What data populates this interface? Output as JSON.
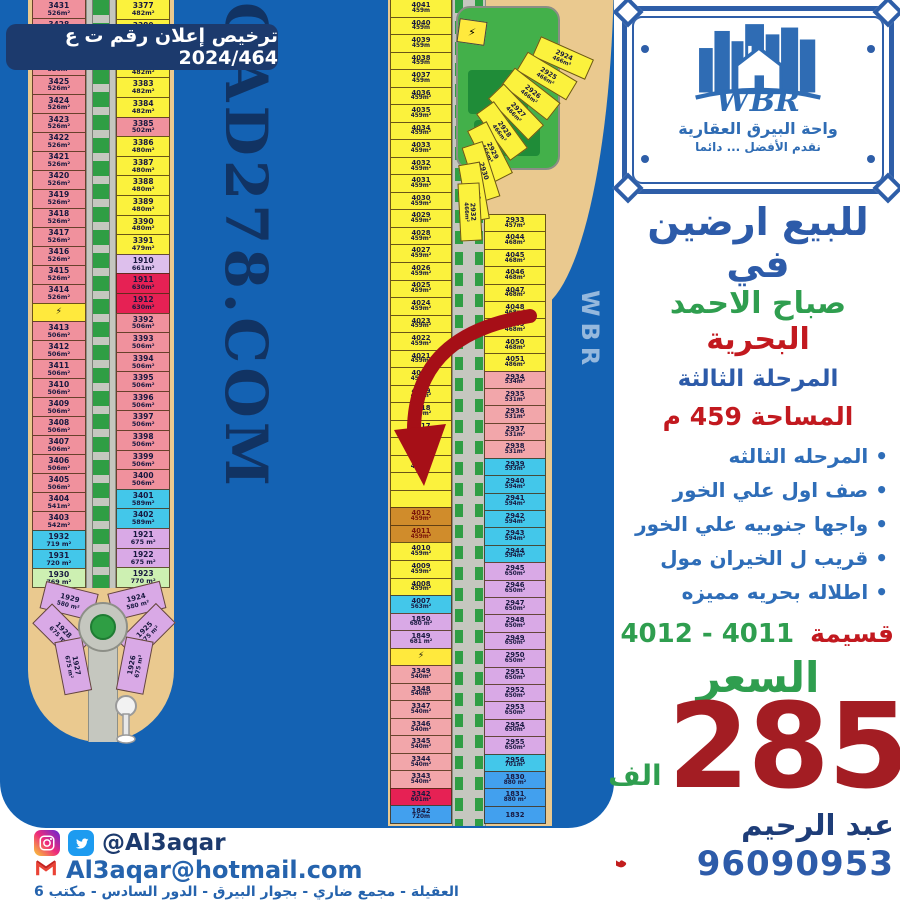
{
  "license": {
    "text": "ترخيص إعلان رقم ت ع 2024/464"
  },
  "logo": {
    "brand": "WBR",
    "line1": "واحة البيرق العقارية",
    "line2": "نقدم الأفضل ... دائما"
  },
  "panel": {
    "headline": "للبيع ارضين في",
    "location_green": "صباح الاحمد",
    "location_red": "البحرية",
    "phase": "المرحلة الثالثة",
    "area_line": "المساحة 459 م",
    "features": [
      {
        "label": "المرحله الثالثه"
      },
      {
        "label": "صف اول علي الخور"
      },
      {
        "label": "واجها جنوبيه علي الخور"
      },
      {
        "label": "قريب ل الخيران مول"
      },
      {
        "label": "اطلاله بحريه مميزه"
      }
    ],
    "parcel_label": "قسيمة",
    "parcel_numbers": "4012 - 4011",
    "price_label": "السعر",
    "price_value": "285",
    "price_unit": "الف",
    "agent_name": "عبد الرحيم",
    "agent_phone": "96090953"
  },
  "footer": {
    "social_handle": "@Al3aqar",
    "email": "Al3aqar@hotmail.com",
    "address": "العقيلة - مجمع ضاري - بجوار البيرق - الدور السادس - مكتب 6"
  },
  "map": {
    "watermark": "QAD278.COM",
    "sea_watermark": "WBR",
    "left_colA": [
      {
        "n": "3431",
        "a": "526m²",
        "c": "pink"
      },
      {
        "n": "3428",
        "a": "526m²",
        "c": "pink"
      },
      {
        "n": "3427",
        "a": "526m²",
        "c": "pink"
      },
      {
        "n": "3426",
        "a": "526m²",
        "c": "pink"
      },
      {
        "n": "3425",
        "a": "526m²",
        "c": "pink"
      },
      {
        "n": "3424",
        "a": "526m²",
        "c": "pink"
      },
      {
        "n": "3423",
        "a": "526m²",
        "c": "pink"
      },
      {
        "n": "3422",
        "a": "526m²",
        "c": "pink"
      },
      {
        "n": "3421",
        "a": "526m²",
        "c": "pink"
      },
      {
        "n": "3420",
        "a": "526m²",
        "c": "pink"
      },
      {
        "n": "3419",
        "a": "526m²",
        "c": "pink"
      },
      {
        "n": "3418",
        "a": "526m²",
        "c": "pink"
      },
      {
        "n": "3417",
        "a": "526m²",
        "c": "pink"
      },
      {
        "n": "3416",
        "a": "526m²",
        "c": "pink"
      },
      {
        "n": "3415",
        "a": "526m²",
        "c": "pink"
      },
      {
        "n": "3414",
        "a": "526m²",
        "c": "pink"
      },
      {
        "n": "",
        "a": "",
        "c": "util"
      },
      {
        "n": "3413",
        "a": "506m²",
        "c": "pink"
      },
      {
        "n": "3412",
        "a": "506m²",
        "c": "pink"
      },
      {
        "n": "3411",
        "a": "506m²",
        "c": "pink"
      },
      {
        "n": "3410",
        "a": "506m²",
        "c": "pink"
      },
      {
        "n": "3409",
        "a": "506m²",
        "c": "pink"
      },
      {
        "n": "3408",
        "a": "506m²",
        "c": "pink"
      },
      {
        "n": "3407",
        "a": "506m²",
        "c": "pink"
      },
      {
        "n": "3406",
        "a": "506m²",
        "c": "pink"
      },
      {
        "n": "3405",
        "a": "506m²",
        "c": "pink"
      },
      {
        "n": "3404",
        "a": "541m²",
        "c": "pink"
      },
      {
        "n": "3403",
        "a": "542m²",
        "c": "pink"
      },
      {
        "n": "1932",
        "a": "719 m²",
        "c": "cyan"
      },
      {
        "n": "1931",
        "a": "720 m²",
        "c": "cyan"
      },
      {
        "n": "1930",
        "a": "769 m²",
        "c": "lightgreen"
      }
    ],
    "left_colB": [
      {
        "n": "3377",
        "a": "482m²",
        "c": "yellow"
      },
      {
        "n": "3380",
        "a": "482m²",
        "c": "yellow"
      },
      {
        "n": "3381",
        "a": "482m²",
        "c": "yellow"
      },
      {
        "n": "3382",
        "a": "482m²",
        "c": "yellow"
      },
      {
        "n": "3383",
        "a": "482m²",
        "c": "yellow"
      },
      {
        "n": "3384",
        "a": "482m²",
        "c": "yellow"
      },
      {
        "n": "3385",
        "a": "502m²",
        "c": "pink"
      },
      {
        "n": "3386",
        "a": "480m²",
        "c": "yellow"
      },
      {
        "n": "3387",
        "a": "480m²",
        "c": "yellow"
      },
      {
        "n": "3388",
        "a": "480m²",
        "c": "yellow"
      },
      {
        "n": "3389",
        "a": "480m²",
        "c": "yellow"
      },
      {
        "n": "3390",
        "a": "480m²",
        "c": "yellow"
      },
      {
        "n": "3391",
        "a": "479m²",
        "c": "yellow"
      },
      {
        "n": "1910",
        "a": "661m²",
        "c": "lavender"
      },
      {
        "n": "1911",
        "a": "630m²",
        "c": "crimson"
      },
      {
        "n": "1912",
        "a": "630m²",
        "c": "crimson"
      },
      {
        "n": "3392",
        "a": "506m²",
        "c": "pink"
      },
      {
        "n": "3393",
        "a": "506m²",
        "c": "pink"
      },
      {
        "n": "3394",
        "a": "506m²",
        "c": "pink"
      },
      {
        "n": "3395",
        "a": "506m²",
        "c": "pink"
      },
      {
        "n": "3396",
        "a": "506m²",
        "c": "pink"
      },
      {
        "n": "3397",
        "a": "506m²",
        "c": "pink"
      },
      {
        "n": "3398",
        "a": "506m²",
        "c": "pink"
      },
      {
        "n": "3399",
        "a": "506m²",
        "c": "pink"
      },
      {
        "n": "3400",
        "a": "506m²",
        "c": "pink"
      },
      {
        "n": "3401",
        "a": "589m²",
        "c": "cyan"
      },
      {
        "n": "3402",
        "a": "589m²",
        "c": "cyan"
      },
      {
        "n": "1921",
        "a": "675 m²",
        "c": "purple"
      },
      {
        "n": "1922",
        "a": "675 m²",
        "c": "purple"
      },
      {
        "n": "1923",
        "a": "770 m²",
        "c": "lightgreen"
      }
    ],
    "left_fanL": [
      {
        "n": "1929",
        "a": "580 m²",
        "c": "purple"
      },
      {
        "n": "1928",
        "a": "675 m²",
        "c": "purple"
      },
      {
        "n": "1927",
        "a": "675 m²",
        "c": "purple"
      }
    ],
    "left_fanR": [
      {
        "n": "1924",
        "a": "580 m²",
        "c": "purple"
      },
      {
        "n": "1925",
        "a": "675 m²",
        "c": "purple"
      },
      {
        "n": "1926",
        "a": "675 m²",
        "c": "purple"
      }
    ],
    "mid_colC": [
      {
        "n": "4041",
        "a": "459m",
        "c": "yellow"
      },
      {
        "n": "4040",
        "a": "459m",
        "c": "yellow"
      },
      {
        "n": "4039",
        "a": "459m",
        "c": "yellow"
      },
      {
        "n": "4038",
        "a": "459m",
        "c": "yellow"
      },
      {
        "n": "4037",
        "a": "459m",
        "c": "yellow"
      },
      {
        "n": "4036",
        "a": "459m²",
        "c": "yellow"
      },
      {
        "n": "4035",
        "a": "459m²",
        "c": "yellow"
      },
      {
        "n": "4034",
        "a": "459m²",
        "c": "yellow"
      },
      {
        "n": "4033",
        "a": "459m²",
        "c": "yellow"
      },
      {
        "n": "4032",
        "a": "459m²",
        "c": "yellow"
      },
      {
        "n": "4031",
        "a": "459m²",
        "c": "yellow"
      },
      {
        "n": "4030",
        "a": "459m²",
        "c": "yellow"
      },
      {
        "n": "4029",
        "a": "459m²",
        "c": "yellow"
      },
      {
        "n": "4028",
        "a": "459m²",
        "c": "yellow"
      },
      {
        "n": "4027",
        "a": "459m²",
        "c": "yellow"
      },
      {
        "n": "4026",
        "a": "459m²",
        "c": "yellow"
      },
      {
        "n": "4025",
        "a": "459m²",
        "c": "yellow"
      },
      {
        "n": "4024",
        "a": "459m²",
        "c": "yellow"
      },
      {
        "n": "4023",
        "a": "459m²",
        "c": "yellow"
      },
      {
        "n": "4022",
        "a": "459m²",
        "c": "yellow"
      },
      {
        "n": "4021",
        "a": "459m²",
        "c": "yellow"
      },
      {
        "n": "4020",
        "a": "459m²",
        "c": "yellow"
      },
      {
        "n": "4019",
        "a": "459m²",
        "c": "yellow"
      },
      {
        "n": "4018",
        "a": "459m²",
        "c": "yellow"
      },
      {
        "n": "4017",
        "a": "459m²",
        "c": "yellow"
      },
      {
        "n": "4016",
        "a": "459m²",
        "c": "yellow"
      },
      {
        "n": "4015",
        "a": "459m²",
        "c": "yellow"
      },
      {
        "n": "",
        "a": "",
        "c": "yellow"
      },
      {
        "n": "",
        "a": "",
        "c": "yellow"
      },
      {
        "n": "4012",
        "a": "459m²",
        "c": "orange"
      },
      {
        "n": "4011",
        "a": "459m²",
        "c": "orange"
      },
      {
        "n": "4010",
        "a": "459m²",
        "c": "yellow"
      },
      {
        "n": "4009",
        "a": "459m²",
        "c": "yellow"
      },
      {
        "n": "4008",
        "a": "459m²",
        "c": "yellow"
      },
      {
        "n": "4007",
        "a": "563m²",
        "c": "cyan"
      },
      {
        "n": "1850",
        "a": "680 m²",
        "c": "purple"
      },
      {
        "n": "1849",
        "a": "681 m²",
        "c": "purple"
      },
      {
        "n": "",
        "a": "",
        "c": "util"
      },
      {
        "n": "3349",
        "a": "540m²",
        "c": "salmon"
      },
      {
        "n": "3348",
        "a": "540m²",
        "c": "salmon"
      },
      {
        "n": "3347",
        "a": "540m²",
        "c": "salmon"
      },
      {
        "n": "3346",
        "a": "540m²",
        "c": "salmon"
      },
      {
        "n": "3345",
        "a": "540m²",
        "c": "salmon"
      },
      {
        "n": "3344",
        "a": "540m²",
        "c": "salmon"
      },
      {
        "n": "3343",
        "a": "540m²",
        "c": "salmon"
      },
      {
        "n": "3342",
        "a": "601m²",
        "c": "crimson"
      },
      {
        "n": "1842",
        "a": "720m",
        "c": "blue"
      }
    ],
    "mid_colD": [
      {
        "n": "2933",
        "a": "457m²",
        "c": "yellow"
      },
      {
        "n": "4044",
        "a": "468m²",
        "c": "yellow"
      },
      {
        "n": "4045",
        "a": "468m²",
        "c": "yellow"
      },
      {
        "n": "4046",
        "a": "468m²",
        "c": "yellow"
      },
      {
        "n": "4047",
        "a": "468m²",
        "c": "yellow"
      },
      {
        "n": "4048",
        "a": "468m²",
        "c": "yellow"
      },
      {
        "n": "4049",
        "a": "468m²",
        "c": "yellow"
      },
      {
        "n": "4050",
        "a": "468m²",
        "c": "yellow"
      },
      {
        "n": "4051",
        "a": "486m²",
        "c": "yellow"
      },
      {
        "n": "2934",
        "a": "534m²",
        "c": "salmon"
      },
      {
        "n": "2935",
        "a": "531m²",
        "c": "salmon"
      },
      {
        "n": "2936",
        "a": "531m²",
        "c": "salmon"
      },
      {
        "n": "2937",
        "a": "531m²",
        "c": "salmon"
      },
      {
        "n": "2938",
        "a": "531m²",
        "c": "salmon"
      },
      {
        "n": "2939",
        "a": "593m²",
        "c": "cyan"
      },
      {
        "n": "2940",
        "a": "594m²",
        "c": "cyan"
      },
      {
        "n": "2941",
        "a": "594m²",
        "c": "cyan"
      },
      {
        "n": "2942",
        "a": "594m²",
        "c": "cyan"
      },
      {
        "n": "2943",
        "a": "594m²",
        "c": "cyan"
      },
      {
        "n": "2944",
        "a": "594m²",
        "c": "cyan"
      },
      {
        "n": "2945",
        "a": "650m²",
        "c": "purple"
      },
      {
        "n": "2946",
        "a": "650m²",
        "c": "purple"
      },
      {
        "n": "2947",
        "a": "650m²",
        "c": "purple"
      },
      {
        "n": "2948",
        "a": "650m²",
        "c": "purple"
      },
      {
        "n": "2949",
        "a": "650m²",
        "c": "purple"
      },
      {
        "n": "2950",
        "a": "650m²",
        "c": "purple"
      },
      {
        "n": "2951",
        "a": "650m²",
        "c": "purple"
      },
      {
        "n": "2952",
        "a": "650m²",
        "c": "purple"
      },
      {
        "n": "2953",
        "a": "650m²",
        "c": "purple"
      },
      {
        "n": "2954",
        "a": "650m²",
        "c": "purple"
      },
      {
        "n": "2955",
        "a": "650m²",
        "c": "purple"
      },
      {
        "n": "2956",
        "a": "701m²",
        "c": "cyan"
      },
      {
        "n": "1830",
        "a": "880 m²",
        "c": "blue"
      },
      {
        "n": "1831",
        "a": "880 m²",
        "c": "blue"
      },
      {
        "n": "1832",
        "a": "",
        "c": "blue"
      }
    ],
    "mid_arc": [
      {
        "n": "2924",
        "a": "466m²",
        "c": "yellow"
      },
      {
        "n": "2925",
        "a": "466m²",
        "c": "yellow"
      },
      {
        "n": "2926",
        "a": "466m²",
        "c": "yellow"
      },
      {
        "n": "2927",
        "a": "466m²",
        "c": "yellow"
      },
      {
        "n": "2928",
        "a": "466m²",
        "c": "yellow"
      },
      {
        "n": "2929",
        "a": "466m²",
        "c": "yellow"
      },
      {
        "n": "2930",
        "a": "466m²",
        "c": "yellow"
      },
      {
        "n": "2931",
        "a": "466m²",
        "c": "yellow"
      },
      {
        "n": "2932",
        "a": "466m²",
        "c": "yellow"
      }
    ]
  }
}
